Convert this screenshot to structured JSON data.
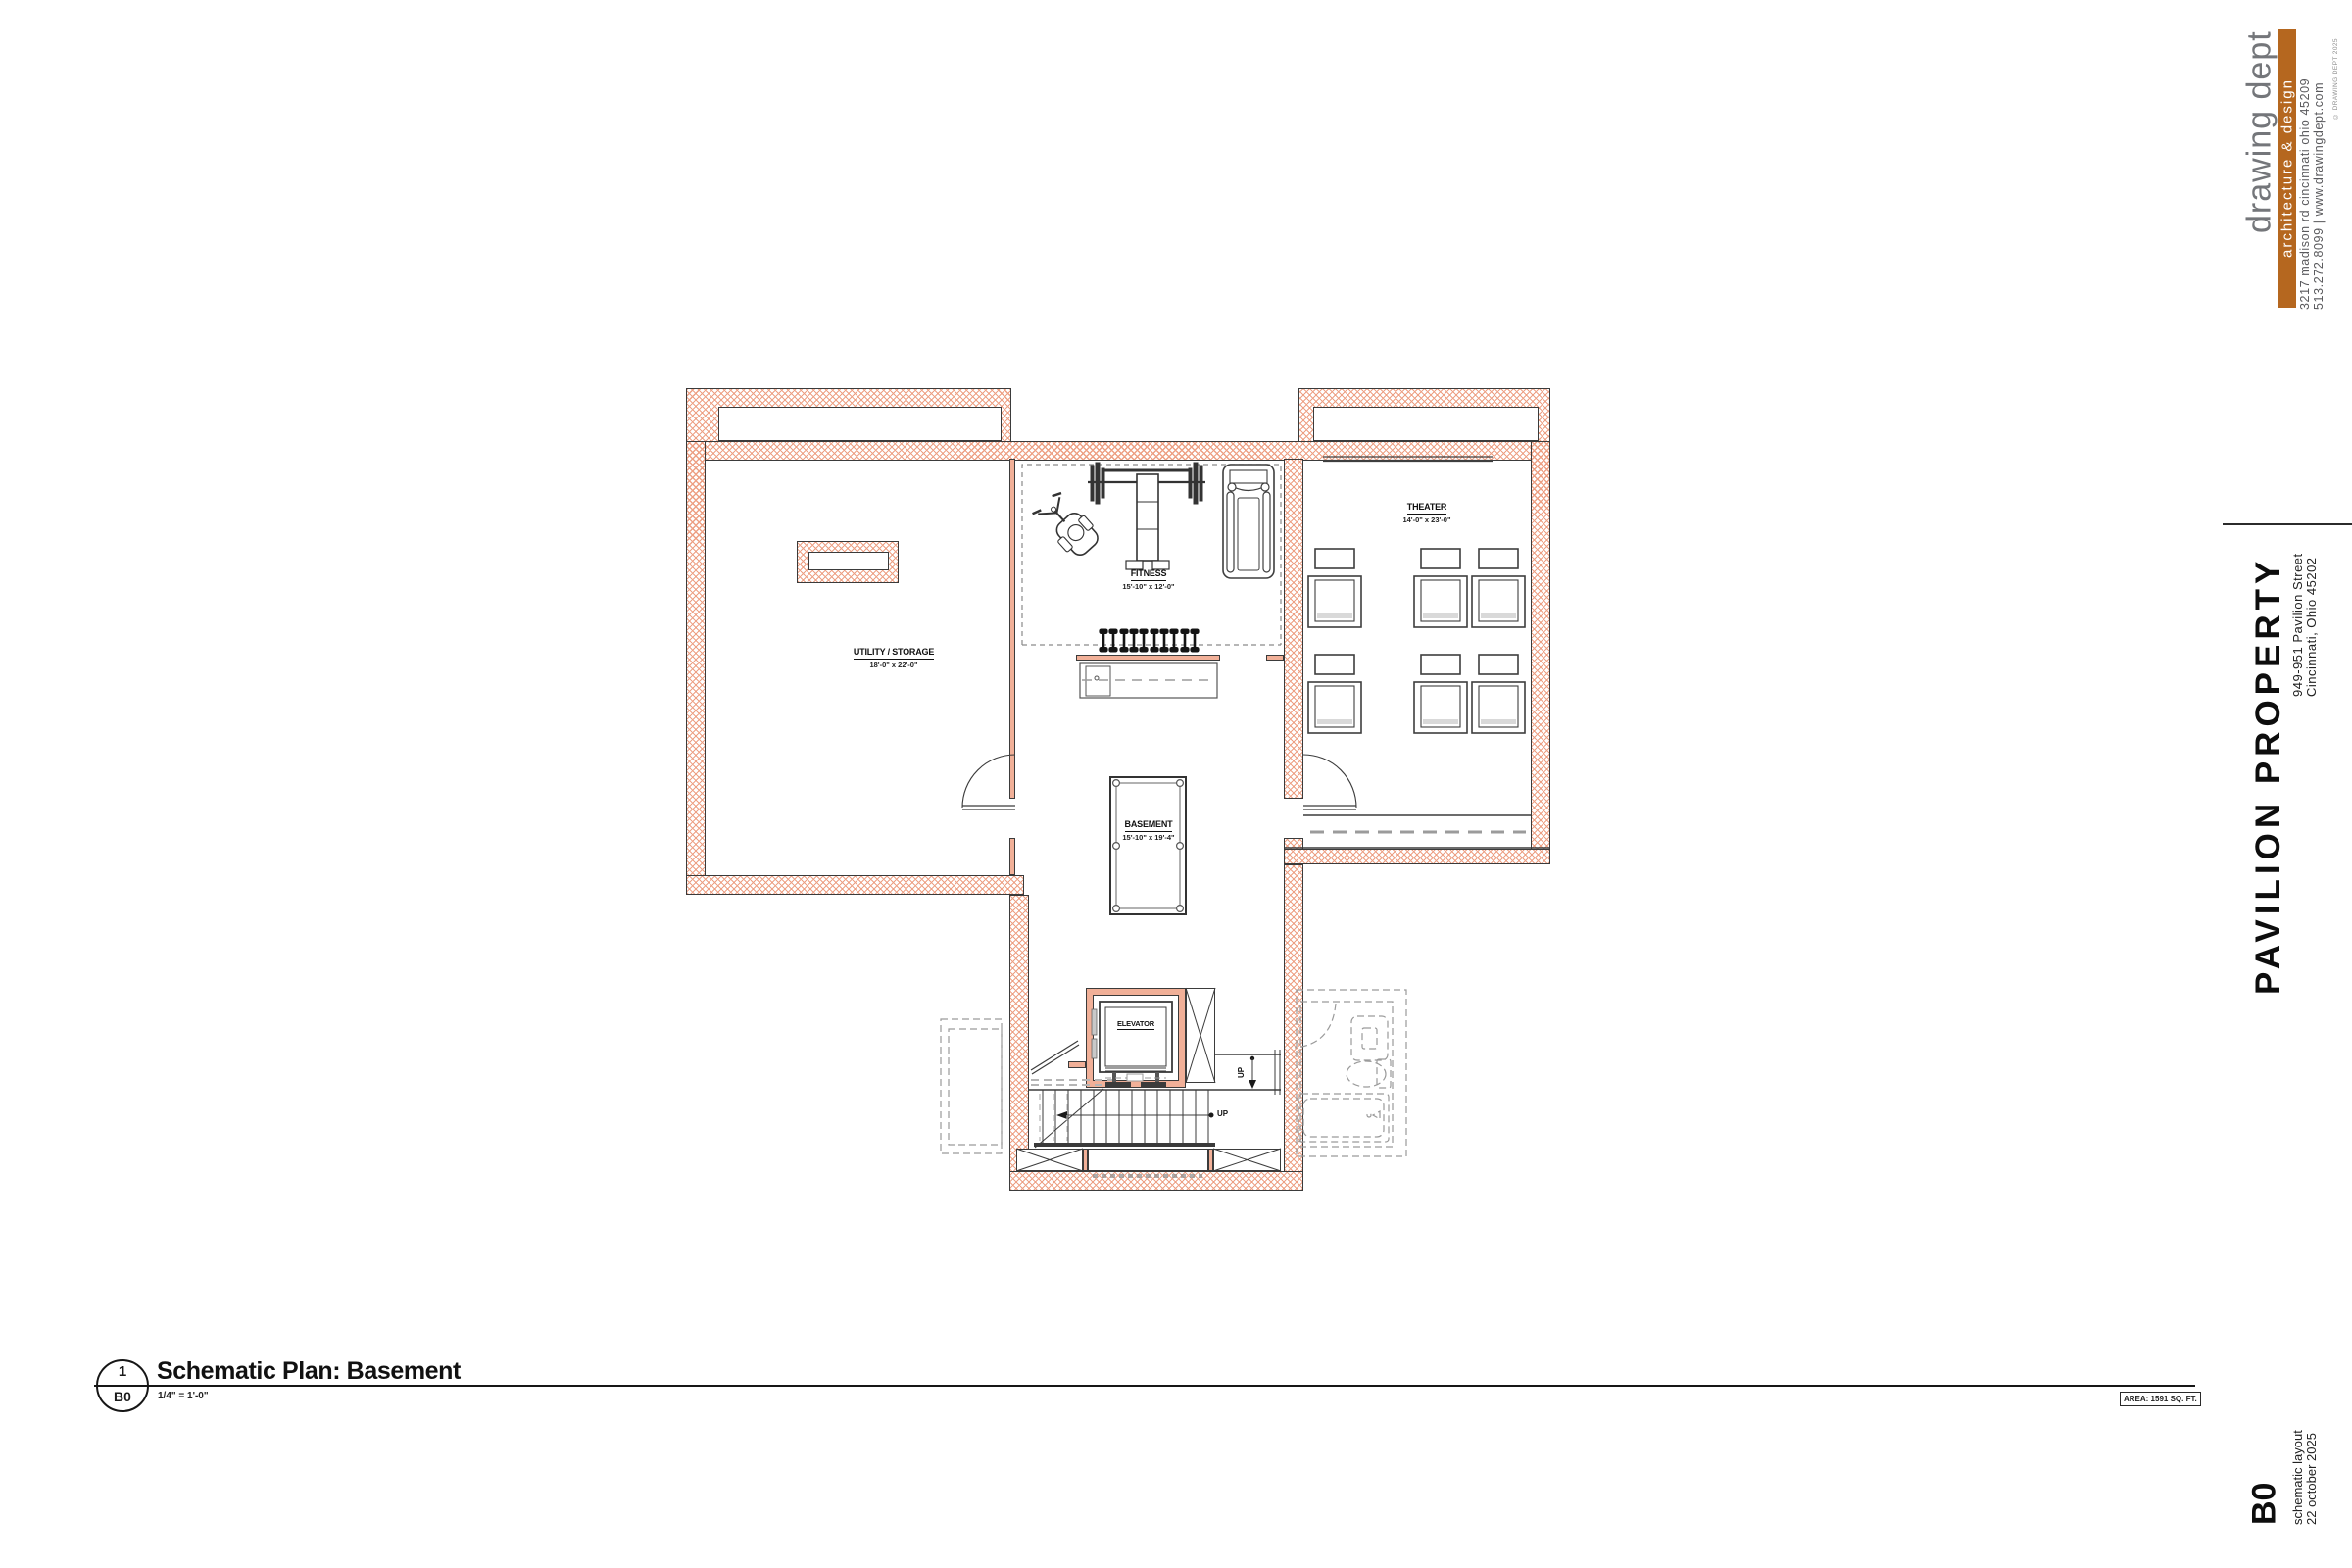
{
  "brand": {
    "name": "drawing dept",
    "tagline": "architecture & design",
    "address": "3217 madison rd cincinnati ohio 45209",
    "contact": "513.272.8099 | www.drawingdept.com",
    "copyright": "© DRAWING DEPT 2025",
    "accent_color": "#b5671f"
  },
  "project": {
    "title": "PAVILION PROPERTY",
    "address_line1": "949-951 Pavilion Street",
    "address_line2": "Cincinnati, Ohio 45202"
  },
  "sheet": {
    "number": "B0",
    "phase": "schematic layout",
    "date": "22 october 2025"
  },
  "titleblock": {
    "detail_number": "1",
    "detail_sheet": "B0",
    "title": "Schematic Plan: Basement",
    "scale": "1/4\" = 1'-0\"",
    "area": "AREA: 1591 SQ. FT."
  },
  "plan": {
    "wall_hatch_color": "#eda084",
    "rooms": [
      {
        "name": "UTILITY / STORAGE",
        "dims": "18'-0\" x 22'-0\""
      },
      {
        "name": "FITNESS",
        "dims": "15'-10\" x 12'-0\""
      },
      {
        "name": "THEATER",
        "dims": "14'-0\" x 23'-0\""
      },
      {
        "name": "BASEMENT",
        "dims": "15'-10\" x 19'-4\""
      },
      {
        "name": "ELEVATOR",
        "dims": ""
      }
    ],
    "up_label": "UP"
  }
}
